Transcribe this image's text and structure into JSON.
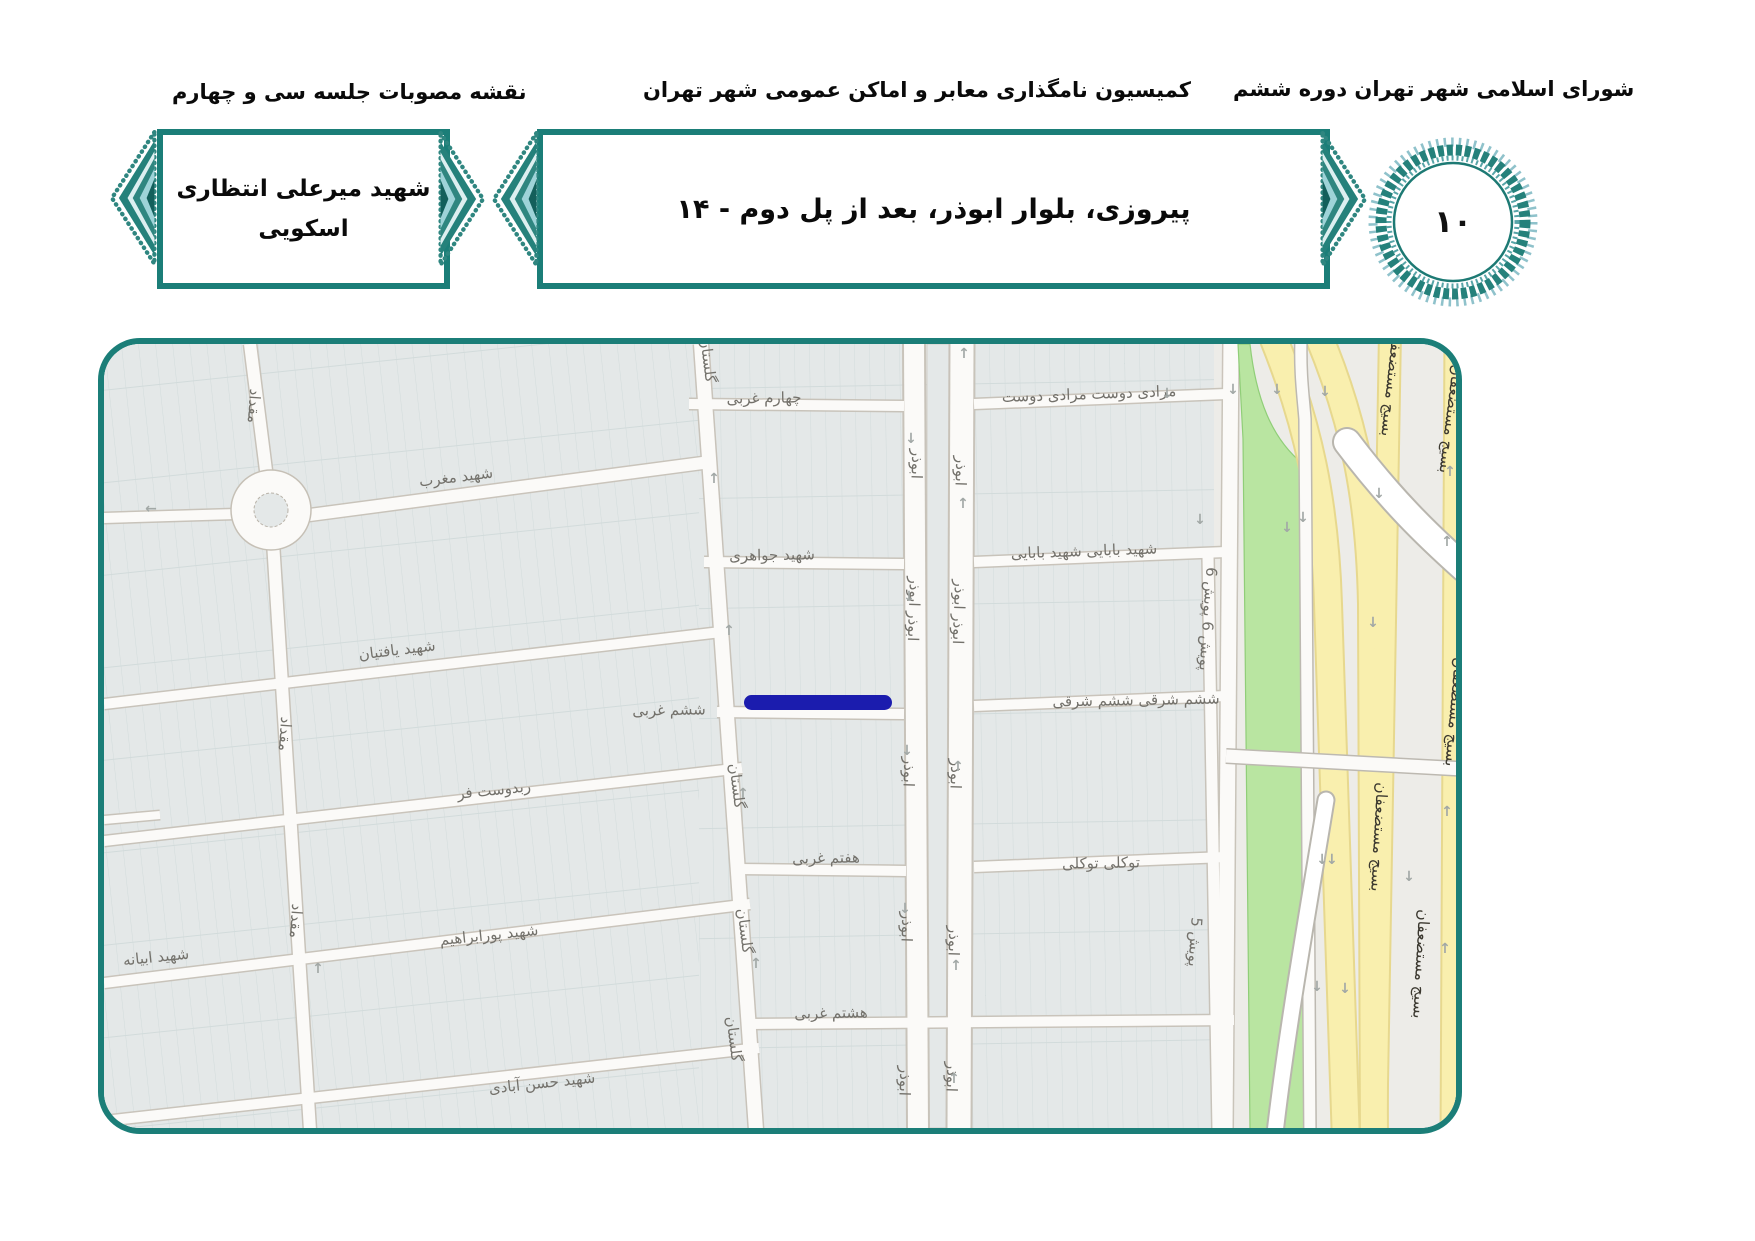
{
  "header": {
    "right_title": "شورای اسلامی شهر تهران دوره ششم",
    "center_title": "کمیسیون نامگذاری معابر و اماکن عمومی شهر تهران",
    "left_title": "نقشه مصوبات جلسه سی و چهارم",
    "location_box": "پیروزی، بلوار ابوذر، بعد از پل دوم - ۱۴",
    "name_box_line1": "شهید میرعلی انتظاری",
    "name_box_line2": "اسکویی",
    "medallion_number": "۱۰"
  },
  "colors": {
    "accent_teal": "#1b7e78",
    "highlight_blue": "#1b1cae",
    "highway_yellow": "#f9efae",
    "green_area": "#b9e5a1"
  },
  "map": {
    "highlight_color": "#1b1cae",
    "highlighted_street": "ششم غربی",
    "labels": [
      {
        "t": "چهارم غربی",
        "x": 660,
        "y": 54,
        "r": -1
      },
      {
        "t": "مرادی دوست مرادی دوست",
        "x": 985,
        "y": 50,
        "r": -2
      },
      {
        "t": "شهید مغرب",
        "x": 352,
        "y": 133,
        "r": -7
      },
      {
        "t": "شهید جواهری",
        "x": 668,
        "y": 211,
        "r": -1
      },
      {
        "t": "شهید بابایی شهید بابایی",
        "x": 980,
        "y": 207,
        "r": -2
      },
      {
        "t": "شهید یافتیان",
        "x": 293,
        "y": 306,
        "r": -7
      },
      {
        "t": "ششم غربی",
        "x": 565,
        "y": 366,
        "r": -1
      },
      {
        "t": "ششم شرقی ششم شرقی",
        "x": 1032,
        "y": 356,
        "r": -1
      },
      {
        "t": "ربدوست فر",
        "x": 390,
        "y": 446,
        "r": -6
      },
      {
        "t": "هفتم غربی",
        "x": 722,
        "y": 514,
        "r": -1
      },
      {
        "t": "توکلی توکلی",
        "x": 997,
        "y": 519,
        "r": -1
      },
      {
        "t": "شهید پورابراهیم",
        "x": 385,
        "y": 591,
        "r": -6
      },
      {
        "t": "شهید ابیانه",
        "x": 52,
        "y": 613,
        "r": -6
      },
      {
        "t": "هشتم غربی",
        "x": 727,
        "y": 669,
        "r": -1
      },
      {
        "t": "شهید حسن آبادی",
        "x": 438,
        "y": 739,
        "r": -6
      },
      {
        "t": "مقداد",
        "x": 150,
        "y": 62,
        "r": 94
      },
      {
        "t": "مقداد",
        "x": 181,
        "y": 390,
        "r": 94
      },
      {
        "t": "مقداد",
        "x": 192,
        "y": 577,
        "r": 94
      },
      {
        "t": "گلستان",
        "x": 604,
        "y": 16,
        "r": 83
      },
      {
        "t": "گلستان",
        "x": 633,
        "y": 442,
        "r": 83
      },
      {
        "t": "گلستان",
        "x": 641,
        "y": 587,
        "r": 83
      },
      {
        "t": "گلستان",
        "x": 630,
        "y": 695,
        "r": 83
      },
      {
        "t": "ابوذر",
        "x": 813,
        "y": 120,
        "r": 92
      },
      {
        "t": "ابوذر",
        "x": 857,
        "y": 127,
        "r": 92
      },
      {
        "t": "ابوذر ابوذر",
        "x": 810,
        "y": 265,
        "r": 92
      },
      {
        "t": "ابوذر ابوذر",
        "x": 855,
        "y": 268,
        "r": 92
      },
      {
        "t": "ابوذر",
        "x": 805,
        "y": 428,
        "r": 92
      },
      {
        "t": "ابوذر",
        "x": 852,
        "y": 430,
        "r": 92
      },
      {
        "t": "ابوذر",
        "x": 803,
        "y": 583,
        "r": 92
      },
      {
        "t": "ابوذر",
        "x": 850,
        "y": 597,
        "r": 92
      },
      {
        "t": "ابوذر",
        "x": 801,
        "y": 737,
        "r": 92
      },
      {
        "t": "ابوذر",
        "x": 848,
        "y": 733,
        "r": 92
      },
      {
        "t": "پویش 6 پویش 6",
        "x": 1104,
        "y": 275,
        "r": 94
      },
      {
        "t": "پویش 5",
        "x": 1091,
        "y": 598,
        "r": 94
      },
      {
        "t": "بسیج مستضعفان",
        "x": 1288,
        "y": 38,
        "r": 96,
        "c": "h"
      },
      {
        "t": "بسیج مستضعفان",
        "x": 1347,
        "y": 75,
        "r": 97,
        "c": "h"
      },
      {
        "t": "بسیج مستضعفان",
        "x": 1275,
        "y": 493,
        "r": 93,
        "c": "h"
      },
      {
        "t": "بسیج مستضعفان",
        "x": 1351,
        "y": 368,
        "r": 95,
        "c": "h"
      },
      {
        "t": "بسیج مستضعفان",
        "x": 1317,
        "y": 620,
        "r": 93,
        "c": "h"
      },
      {
        "t": "←",
        "x": 46,
        "y": 165,
        "c": "a"
      },
      {
        "t": "↑",
        "x": 609,
        "y": 135,
        "c": "a"
      },
      {
        "t": "↑",
        "x": 624,
        "y": 287,
        "c": "a"
      },
      {
        "t": "↑",
        "x": 638,
        "y": 450,
        "c": "a"
      },
      {
        "t": "↑",
        "x": 651,
        "y": 620,
        "c": "a"
      },
      {
        "t": "↑",
        "x": 213,
        "y": 625,
        "c": "a"
      },
      {
        "t": "↓",
        "x": 806,
        "y": 95,
        "c": "a"
      },
      {
        "t": "↓",
        "x": 804,
        "y": 253,
        "c": "a"
      },
      {
        "t": "↓",
        "x": 802,
        "y": 407,
        "c": "a"
      },
      {
        "t": "↓",
        "x": 800,
        "y": 565,
        "c": "a"
      },
      {
        "t": "↑",
        "x": 859,
        "y": 10,
        "c": "a"
      },
      {
        "t": "↑",
        "x": 858,
        "y": 160,
        "c": "a"
      },
      {
        "t": "↑",
        "x": 853,
        "y": 423,
        "c": "a"
      },
      {
        "t": "↑",
        "x": 851,
        "y": 622,
        "c": "a"
      },
      {
        "t": "↑",
        "x": 849,
        "y": 735,
        "c": "a"
      },
      {
        "t": "↓",
        "x": 1062,
        "y": 50,
        "c": "a"
      },
      {
        "t": "↓",
        "x": 1128,
        "y": 46,
        "c": "a"
      },
      {
        "t": "↓",
        "x": 1172,
        "y": 46,
        "c": "a"
      },
      {
        "t": "↓",
        "x": 1220,
        "y": 48,
        "c": "a"
      },
      {
        "t": "↓",
        "x": 1095,
        "y": 176,
        "c": "a"
      },
      {
        "t": "↓",
        "x": 1198,
        "y": 174,
        "c": "a"
      },
      {
        "t": "↓",
        "x": 1182,
        "y": 184,
        "c": "a"
      },
      {
        "t": "↓",
        "x": 1274,
        "y": 150,
        "c": "a"
      },
      {
        "t": "↓",
        "x": 1268,
        "y": 279,
        "c": "a"
      },
      {
        "t": "↓",
        "x": 1304,
        "y": 533,
        "c": "a"
      },
      {
        "t": "↓↓",
        "x": 1222,
        "y": 516,
        "c": "a"
      },
      {
        "t": "↓",
        "x": 1212,
        "y": 643,
        "c": "a"
      },
      {
        "t": "↓",
        "x": 1240,
        "y": 645,
        "c": "a"
      },
      {
        "t": "↑",
        "x": 1345,
        "y": 128,
        "c": "a"
      },
      {
        "t": "↑",
        "x": 1342,
        "y": 198,
        "c": "a"
      },
      {
        "t": "↑",
        "x": 1342,
        "y": 468,
        "c": "a"
      },
      {
        "t": "↑",
        "x": 1340,
        "y": 605,
        "c": "a"
      }
    ]
  }
}
